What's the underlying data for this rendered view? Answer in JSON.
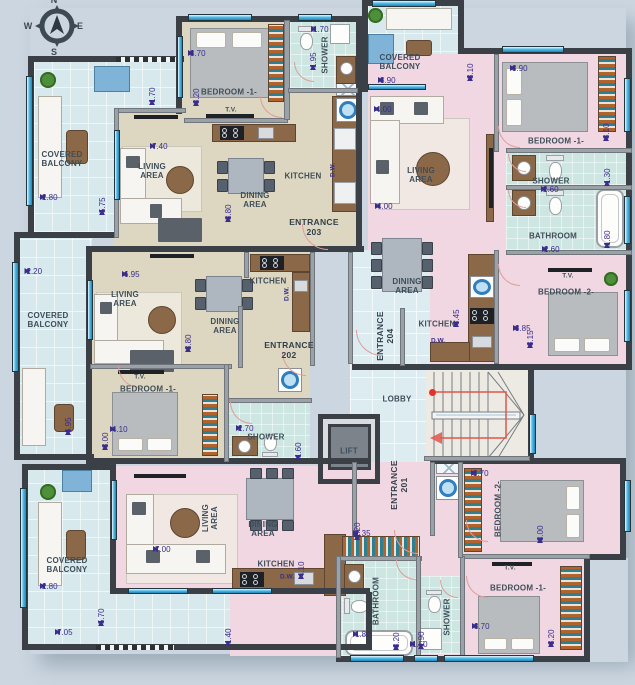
{
  "plan": {
    "compass": {
      "north": "N",
      "west": "W",
      "east": "E",
      "south": "S"
    },
    "colors": {
      "background": "#cbd6e0",
      "floor_beige": "#ddd7c1",
      "floor_pink": "#f1d7e2",
      "balcony_tile": "#d7e9ec",
      "bath_tile": "#cde6e1",
      "wall_dark": "#3b4046",
      "wall_light": "#9aa1a7",
      "window_blue": "#55bce8",
      "dimension_purple": "#3a2d8c",
      "label_slate": "#3e4e5a",
      "door_arc": "#dd9d9d",
      "stair_route_red": "#e0342b"
    },
    "rooms": [
      {
        "text": "COVERED\nBALCONY",
        "x": 62,
        "y": 160
      },
      {
        "text": "BEDROOM -1-",
        "x": 229,
        "y": 93
      },
      {
        "text": "T.V.",
        "x": 231,
        "y": 110,
        "small": true
      },
      {
        "text": "SHOWER",
        "x": 326,
        "y": 55,
        "rot": -90
      },
      {
        "text": "KITCHEN",
        "x": 303,
        "y": 177
      },
      {
        "text": "DINING\nAREA",
        "x": 255,
        "y": 201
      },
      {
        "text": "LIVING\nAREA",
        "x": 152,
        "y": 172
      },
      {
        "text": "COVERED\nBALCONY",
        "x": 400,
        "y": 63
      },
      {
        "text": "BEDROOM -1-",
        "x": 556,
        "y": 142
      },
      {
        "text": "SHOWER",
        "x": 551,
        "y": 182
      },
      {
        "text": "BATHROOM",
        "x": 553,
        "y": 237
      },
      {
        "text": "T.V.",
        "x": 568,
        "y": 276,
        "small": true
      },
      {
        "text": "BEDROOM -2-",
        "x": 566,
        "y": 293
      },
      {
        "text": "LIVING\nAREA",
        "x": 421,
        "y": 176
      },
      {
        "text": "DINING\nAREA",
        "x": 407,
        "y": 287
      },
      {
        "text": "KITCHEN",
        "x": 437,
        "y": 325
      },
      {
        "text": "COVERED\nBALCONY",
        "x": 48,
        "y": 321
      },
      {
        "text": "LIVING\nAREA",
        "x": 125,
        "y": 300
      },
      {
        "text": "DINING\nAREA",
        "x": 225,
        "y": 327
      },
      {
        "text": "KITCHEN",
        "x": 268,
        "y": 282
      },
      {
        "text": "T.V.",
        "x": 140,
        "y": 377,
        "small": true
      },
      {
        "text": "BEDROOM -1-",
        "x": 148,
        "y": 390
      },
      {
        "text": "SHOWER",
        "x": 266,
        "y": 438
      },
      {
        "text": "LOBBY",
        "x": 397,
        "y": 400
      },
      {
        "text": "LIFT",
        "x": 349,
        "y": 452
      },
      {
        "text": "COVERED\nBALCONY",
        "x": 67,
        "y": 566
      },
      {
        "text": "LIVING\nAREA",
        "x": 211,
        "y": 518,
        "rot": -90
      },
      {
        "text": "DINING\nAREA",
        "x": 263,
        "y": 530
      },
      {
        "text": "KITCHEN",
        "x": 276,
        "y": 565
      },
      {
        "text": "BEDROOM -2-",
        "x": 499,
        "y": 509,
        "rot": -90
      },
      {
        "text": "T.V.",
        "x": 510,
        "y": 568,
        "small": true
      },
      {
        "text": "BEDROOM -1-",
        "x": 518,
        "y": 589
      },
      {
        "text": "BATHROOM",
        "x": 377,
        "y": 601,
        "rot": -90
      },
      {
        "text": "SHOWER",
        "x": 448,
        "y": 617,
        "rot": -90
      }
    ],
    "entrances": [
      {
        "text": "ENTRANCE",
        "number": "203",
        "x": 314,
        "y": 228,
        "rot": 0
      },
      {
        "text": "ENTRANCE",
        "number": "204",
        "x": 386,
        "y": 336,
        "rot": -90
      },
      {
        "text": "ENTRANCE",
        "number": "202",
        "x": 289,
        "y": 351,
        "rot": 0
      },
      {
        "text": "ENTRANCE",
        "number": "201",
        "x": 400,
        "y": 485,
        "rot": -90
      }
    ],
    "appliance_labels": [
      {
        "text": "D.W.",
        "x": 333,
        "y": 170,
        "rot": -90
      },
      {
        "text": "D.W.",
        "x": 438,
        "y": 341,
        "rot": 0
      },
      {
        "text": "D.W.",
        "x": 287,
        "y": 294,
        "rot": -90
      },
      {
        "text": "D.W.",
        "x": 287,
        "y": 577,
        "rot": 0
      }
    ],
    "dimensions": [
      {
        "v": "1.70",
        "x": 152,
        "y": 83,
        "o": "v",
        "len": 44
      },
      {
        "v": "5.75",
        "x": 102,
        "y": 145,
        "o": "v",
        "len": 140
      },
      {
        "v": "2.80",
        "x": 75,
        "y": 197,
        "o": "h",
        "len": 70
      },
      {
        "v": "3.20",
        "x": 196,
        "y": 66,
        "o": "v",
        "len": 80
      },
      {
        "v": "3.70",
        "x": 233,
        "y": 53,
        "o": "h",
        "len": 90
      },
      {
        "v": "1.95",
        "x": 313,
        "y": 46,
        "o": "v",
        "len": 48
      },
      {
        "v": "1.70",
        "x": 331,
        "y": 29,
        "o": "h",
        "len": 40
      },
      {
        "v": "7.40",
        "x": 240,
        "y": 146,
        "o": "h",
        "len": 180
      },
      {
        "v": "3.80",
        "x": 228,
        "y": 176,
        "o": "v",
        "len": 92
      },
      {
        "v": "3.10",
        "x": 470,
        "y": 44,
        "o": "v",
        "len": 74
      },
      {
        "v": "3.90",
        "x": 424,
        "y": 80,
        "o": "h",
        "len": 92
      },
      {
        "v": "3.90",
        "x": 557,
        "y": 68,
        "o": "h",
        "len": 94
      },
      {
        "v": "3.10",
        "x": 606,
        "y": 104,
        "o": "v",
        "len": 74
      },
      {
        "v": "4.00",
        "x": 424,
        "y": 109,
        "o": "h",
        "len": 100
      },
      {
        "v": "2.60",
        "x": 572,
        "y": 189,
        "o": "h",
        "len": 62
      },
      {
        "v": "1.30",
        "x": 607,
        "y": 170,
        "o": "v",
        "len": 32
      },
      {
        "v": "2.60",
        "x": 573,
        "y": 249,
        "o": "h",
        "len": 62
      },
      {
        "v": "1.80",
        "x": 607,
        "y": 226,
        "o": "v",
        "len": 44
      },
      {
        "v": "4.00",
        "x": 425,
        "y": 206,
        "o": "h",
        "len": 100
      },
      {
        "v": "8.45",
        "x": 456,
        "y": 224,
        "o": "v",
        "len": 206
      },
      {
        "v": "3.15",
        "x": 530,
        "y": 310,
        "o": "v",
        "len": 76
      },
      {
        "v": "3.85",
        "x": 560,
        "y": 328,
        "o": "h",
        "len": 94
      },
      {
        "v": "2.20",
        "x": 52,
        "y": 271,
        "o": "h",
        "len": 55
      },
      {
        "v": "6.95",
        "x": 68,
        "y": 351,
        "o": "v",
        "len": 168
      },
      {
        "v": "6.95",
        "x": 205,
        "y": 274,
        "o": "h",
        "len": 166
      },
      {
        "v": "3.80",
        "x": 188,
        "y": 306,
        "o": "v",
        "len": 92
      },
      {
        "v": "3.00",
        "x": 105,
        "y": 414,
        "o": "v",
        "len": 72
      },
      {
        "v": "4.10",
        "x": 160,
        "y": 429,
        "o": "h",
        "len": 100
      },
      {
        "v": "2.70",
        "x": 268,
        "y": 428,
        "o": "h",
        "len": 64
      },
      {
        "v": "1.60",
        "x": 298,
        "y": 440,
        "o": "v",
        "len": 40
      },
      {
        "v": "2.20",
        "x": 357,
        "y": 513,
        "o": "v",
        "len": 54
      },
      {
        "v": "2.35",
        "x": 382,
        "y": 533,
        "o": "h",
        "len": 58
      },
      {
        "v": "3.70",
        "x": 517,
        "y": 473,
        "o": "h",
        "len": 92
      },
      {
        "v": "3.00",
        "x": 540,
        "y": 507,
        "o": "v",
        "len": 72
      },
      {
        "v": "3.70",
        "x": 518,
        "y": 626,
        "o": "h",
        "len": 92
      },
      {
        "v": "3.20",
        "x": 551,
        "y": 608,
        "o": "v",
        "len": 78
      },
      {
        "v": "3.20",
        "x": 396,
        "y": 611,
        "o": "v",
        "len": 78
      },
      {
        "v": "1.80",
        "x": 375,
        "y": 634,
        "o": "h",
        "len": 44
      },
      {
        "v": "1.90",
        "x": 421,
        "y": 626,
        "o": "v",
        "len": 46
      },
      {
        "v": "1.50",
        "x": 429,
        "y": 644,
        "o": "h",
        "len": 38
      },
      {
        "v": "7.00",
        "x": 238,
        "y": 549,
        "o": "h",
        "len": 170
      },
      {
        "v": "4.10",
        "x": 301,
        "y": 529,
        "o": "v",
        "len": 100
      },
      {
        "v": "2.80",
        "x": 74,
        "y": 586,
        "o": "h",
        "len": 68
      },
      {
        "v": "5.70",
        "x": 101,
        "y": 558,
        "o": "v",
        "len": 136
      },
      {
        "v": "7.05",
        "x": 140,
        "y": 632,
        "o": "h",
        "len": 170
      },
      {
        "v": "1.40",
        "x": 228,
        "y": 628,
        "o": "v",
        "len": 36
      }
    ]
  }
}
